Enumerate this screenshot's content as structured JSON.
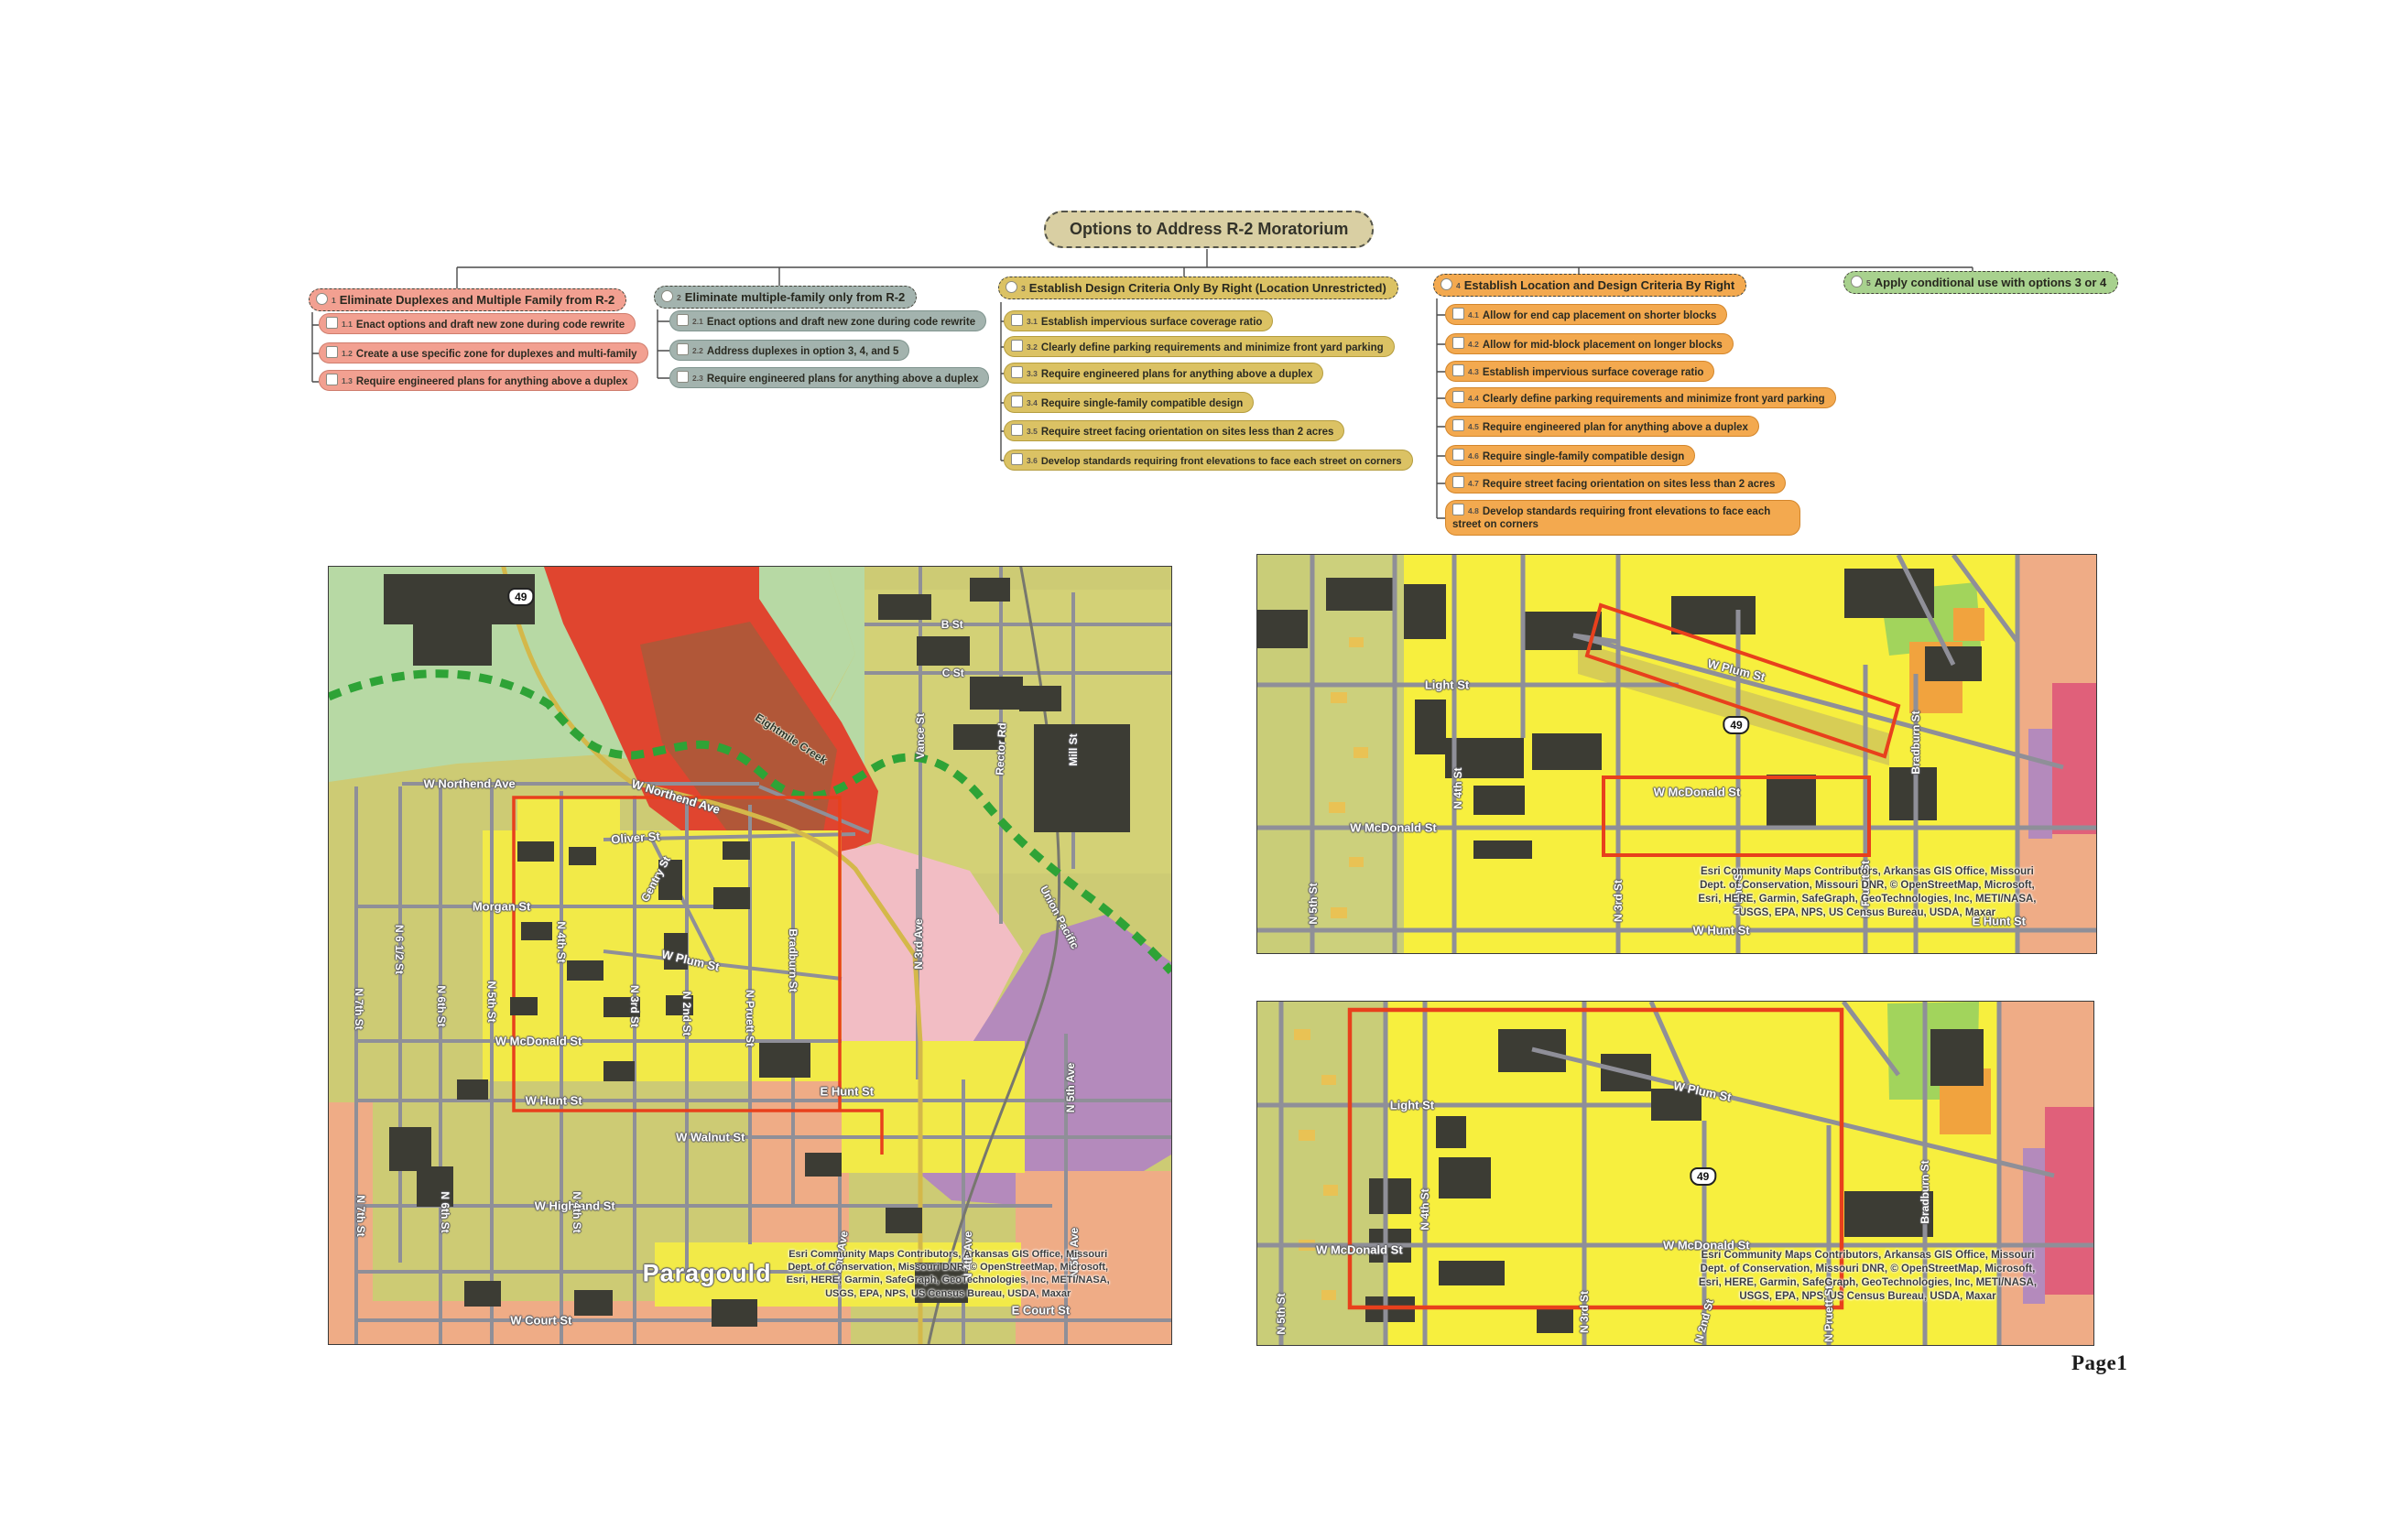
{
  "page": {
    "label": "Page1"
  },
  "colors": {
    "olive": "#cdcb74",
    "olive_detail": "#d9d973",
    "green_open": "#b7d9a4",
    "green_parcel": "#a2d45c",
    "parcel_yellow": "#f2ea48",
    "parcel_bright": "#f7ef3e",
    "red_zone": "#e0452f",
    "red_dark": "#a85a3a",
    "pink_zone": "#f2bdc4",
    "magenta_zone": "#e0607a",
    "purple_zone": "#b48abc",
    "salmon_zone": "#efac86",
    "orange_parcel": "#f1a33e",
    "building": "#3c3c34",
    "road": "#8f8f98",
    "creek": "#2ea336",
    "boundary_red": "#e8401c",
    "highway_gold": "#d4b84a"
  },
  "flowchart": {
    "title": "Options to Address R-2 Moratorium",
    "title_fill": "#d9cfa3",
    "title_border": "#55554a",
    "options": [
      {
        "id": "1",
        "label": "Eliminate Duplexes and Multiple Family from R-2",
        "fill": "#f2a091",
        "border": "#cf7d6d",
        "items": [
          {
            "id": "1.1",
            "label": "Enact options and draft new zone during code rewrite"
          },
          {
            "id": "1.2",
            "label": "Create a use specific zone for duplexes and multi-family"
          },
          {
            "id": "1.3",
            "label": "Require engineered plans for anything above a duplex"
          }
        ]
      },
      {
        "id": "2",
        "label": "Eliminate multiple-family only from R-2",
        "fill": "#a3b3ae",
        "border": "#7f948e",
        "items": [
          {
            "id": "2.1",
            "label": "Enact options and draft new zone during code rewrite"
          },
          {
            "id": "2.2",
            "label": "Address duplexes in option 3, 4, and 5"
          },
          {
            "id": "2.3",
            "label": "Require engineered plans for anything above a duplex"
          }
        ]
      },
      {
        "id": "3",
        "label": "Establish Design Criteria Only By Right (Location Unrestricted)",
        "fill": "#dbc264",
        "border": "#b59d3e",
        "items": [
          {
            "id": "3.1",
            "label": "Establish impervious surface coverage ratio"
          },
          {
            "id": "3.2",
            "label": "Clearly define parking requirements and minimize front yard parking"
          },
          {
            "id": "3.3",
            "label": "Require engineered plans for anything above a duplex"
          },
          {
            "id": "3.4",
            "label": "Require single-family compatible design"
          },
          {
            "id": "3.5",
            "label": "Require street facing orientation on sites less than 2 acres"
          },
          {
            "id": "3.6",
            "label": "Develop standards requiring front elevations to face each street on corners"
          }
        ]
      },
      {
        "id": "4",
        "label": "Establish Location and Design Criteria By Right",
        "fill": "#f3a94f",
        "border": "#d3862b",
        "items": [
          {
            "id": "4.1",
            "label": "Allow for end cap placement on shorter blocks"
          },
          {
            "id": "4.2",
            "label": "Allow for mid-block placement on longer blocks"
          },
          {
            "id": "4.3",
            "label": "Establish impervious surface coverage ratio"
          },
          {
            "id": "4.4",
            "label": "Clearly define parking requirements and minimize front yard parking"
          },
          {
            "id": "4.5",
            "label": "Require engineered plan for anything above a duplex"
          },
          {
            "id": "4.6",
            "label": "Require single-family compatible design"
          },
          {
            "id": "4.7",
            "label": "Require street facing orientation on sites less than 2 acres"
          },
          {
            "id": "4.8",
            "label": "Develop standards requiring front elevations to face each street on corners"
          }
        ]
      },
      {
        "id": "5",
        "label": "Apply conditional use with options 3 or 4",
        "fill": "#a8d18e",
        "border": "#7fae62",
        "items": []
      }
    ]
  },
  "maps": {
    "attribution_lines": [
      "Esri Community Maps Contributors, Arkansas GIS Office, Missouri",
      "Dept. of Conservation, Missouri DNR, © OpenStreetMap, Microsoft,",
      "Esri, HERE, Garmin, SafeGraph, GeoTechnologies, Inc, METI/NASA,",
      "USGS, EPA, NPS, US Census Bureau, USDA, Maxar"
    ],
    "overview": {
      "labels": [
        {
          "text": "49",
          "cls": "shield",
          "name": "highway-49-shield",
          "x": 22.8,
          "y": 3.9
        },
        {
          "text": "W Northend Ave",
          "x": 16.7,
          "y": 27.9,
          "size": 13
        },
        {
          "text": "W Northend Ave",
          "x": 41.2,
          "y": 29.6,
          "rot": 17,
          "size": 13
        },
        {
          "text": "Oliver St",
          "x": 36.4,
          "y": 34.9,
          "rot": -4,
          "size": 13
        },
        {
          "text": "Morgan St",
          "x": 20.5,
          "y": 43.7,
          "size": 13
        },
        {
          "text": "Gentry St",
          "x": 38.8,
          "y": 40.2,
          "rot": -62
        },
        {
          "text": "W Plum St",
          "x": 42.9,
          "y": 50.6,
          "rot": 13,
          "size": 13
        },
        {
          "text": "N 7th St",
          "x": 3.6,
          "y": 56.9,
          "rot": 90
        },
        {
          "text": "N 6 1/2 St",
          "x": 8.4,
          "y": 49.2,
          "rot": 90
        },
        {
          "text": "N 6th St",
          "x": 13.4,
          "y": 56.5,
          "rot": 90
        },
        {
          "text": "N 5th St",
          "x": 19.3,
          "y": 56.0,
          "rot": 90
        },
        {
          "text": "N 4th St",
          "x": 27.6,
          "y": 48.3,
          "rot": 90
        },
        {
          "text": "N 3rd St",
          "x": 36.3,
          "y": 56.5,
          "rot": 90
        },
        {
          "text": "N 2nd St",
          "x": 42.5,
          "y": 57.5,
          "rot": 90
        },
        {
          "text": "N Pruett St",
          "x": 50.0,
          "y": 58.1,
          "rot": 90
        },
        {
          "text": "Bradburn St",
          "x": 55.1,
          "y": 50.6,
          "rot": 90
        },
        {
          "text": "W McDonald St",
          "x": 24.9,
          "y": 61.0,
          "size": 13
        },
        {
          "text": "W Hunt St",
          "x": 26.7,
          "y": 68.7,
          "size": 13
        },
        {
          "text": "E Hunt St",
          "x": 61.5,
          "y": 67.5,
          "size": 13
        },
        {
          "text": "W Walnut St",
          "x": 45.3,
          "y": 73.4,
          "size": 13
        },
        {
          "text": "W Highland St",
          "x": 29.2,
          "y": 82.2,
          "size": 13
        },
        {
          "text": "W Court St",
          "x": 25.2,
          "y": 96.9,
          "size": 13
        },
        {
          "text": "E Court St",
          "x": 84.5,
          "y": 95.6,
          "size": 13
        },
        {
          "text": "Paragould",
          "cls": "city",
          "name": "city-label",
          "x": 44.9,
          "y": 90.9
        },
        {
          "text": "B St",
          "x": 74.0,
          "y": 7.4
        },
        {
          "text": "C St",
          "x": 74.1,
          "y": 13.7
        },
        {
          "text": "Vance St",
          "x": 70.2,
          "y": 21.8,
          "rot": -90
        },
        {
          "text": "Rector Rd",
          "x": 79.8,
          "y": 23.4,
          "rot": -87
        },
        {
          "text": "Mill St",
          "x": 88.4,
          "y": 23.6,
          "rot": -90
        },
        {
          "text": "Eightmile Creek",
          "cls": "dark",
          "name": "creek-label",
          "x": 54.9,
          "y": 22.1,
          "rot": 33
        },
        {
          "text": "Union Pacific",
          "name": "railroad-label",
          "x": 86.7,
          "y": 45.1,
          "rot": 62
        },
        {
          "text": "N 3rd Ave",
          "x": 70.0,
          "y": 48.5,
          "rot": -90
        },
        {
          "text": "N 5th Ave",
          "x": 88.0,
          "y": 67.0,
          "rot": -90
        },
        {
          "text": "N 2nd Ave",
          "x": 60.7,
          "y": 88.8,
          "rot": -80
        },
        {
          "text": "N 4th Ave",
          "x": 75.9,
          "y": 88.7,
          "rot": -90
        },
        {
          "text": "N 5th Ave",
          "x": 88.5,
          "y": 88.2,
          "rot": -90
        },
        {
          "text": "N 7th St",
          "x": 3.8,
          "y": 83.5,
          "rot": 90
        },
        {
          "text": "N 6th St",
          "x": 13.8,
          "y": 83.0,
          "rot": 90
        },
        {
          "text": "N 4th St",
          "x": 29.5,
          "y": 83.0,
          "rot": 90
        }
      ]
    },
    "detail_top": {
      "labels": [
        {
          "text": "49",
          "cls": "shield",
          "name": "highway-49-shield",
          "x": 57.1,
          "y": 42.8
        },
        {
          "text": "Light St",
          "x": 22.6,
          "y": 32.6,
          "size": 13
        },
        {
          "text": "N 4th St",
          "x": 23.9,
          "y": 58.6,
          "rot": -90
        },
        {
          "text": "N 5th St",
          "x": 6.7,
          "y": 87.6,
          "rot": -90
        },
        {
          "text": "N 3rd St",
          "x": 43.0,
          "y": 86.9,
          "rot": -90
        },
        {
          "text": "W McDonald St",
          "x": 16.2,
          "y": 68.5,
          "size": 13
        },
        {
          "text": "W Plum St",
          "x": 57.1,
          "y": 29.0,
          "rot": 14,
          "size": 13
        },
        {
          "text": "W McDonald St",
          "x": 52.4,
          "y": 59.5,
          "size": 13
        },
        {
          "text": "Bradburn St",
          "x": 78.5,
          "y": 47.1,
          "rot": -90
        },
        {
          "text": "N 2nd St",
          "x": 57.3,
          "y": 84.6,
          "rot": -90
        },
        {
          "text": "N Pruett St",
          "x": 72.5,
          "y": 83.9,
          "rot": -90
        },
        {
          "text": "W Hunt St",
          "x": 55.3,
          "y": 94.3,
          "size": 13
        },
        {
          "text": "E Hunt St",
          "x": 88.4,
          "y": 92.0,
          "size": 13
        }
      ]
    },
    "detail_bottom": {
      "labels": [
        {
          "text": "49",
          "cls": "shield",
          "name": "highway-49-shield",
          "x": 53.3,
          "y": 51.0
        },
        {
          "text": "Light St",
          "x": 18.5,
          "y": 30.1,
          "size": 13
        },
        {
          "text": "N 4th St",
          "x": 20.0,
          "y": 60.5,
          "rot": -90
        },
        {
          "text": "W McDonald St",
          "x": 12.2,
          "y": 72.3,
          "size": 13
        },
        {
          "text": "N 5th St",
          "x": 2.8,
          "y": 91.0,
          "rot": -90
        },
        {
          "text": "N 3rd St",
          "x": 39.1,
          "y": 90.4,
          "rot": -90
        },
        {
          "text": "W Plum St",
          "x": 53.2,
          "y": 26.0,
          "rot": 12,
          "size": 13
        },
        {
          "text": "W McDonald St",
          "x": 53.7,
          "y": 70.9,
          "size": 13
        },
        {
          "text": "Bradburn St",
          "x": 79.8,
          "y": 55.5,
          "rot": -90
        },
        {
          "text": "N 2nd St",
          "x": 53.4,
          "y": 93.0,
          "rot": -75
        },
        {
          "text": "N Pruett St",
          "x": 68.3,
          "y": 91.0,
          "rot": -90
        }
      ]
    }
  }
}
